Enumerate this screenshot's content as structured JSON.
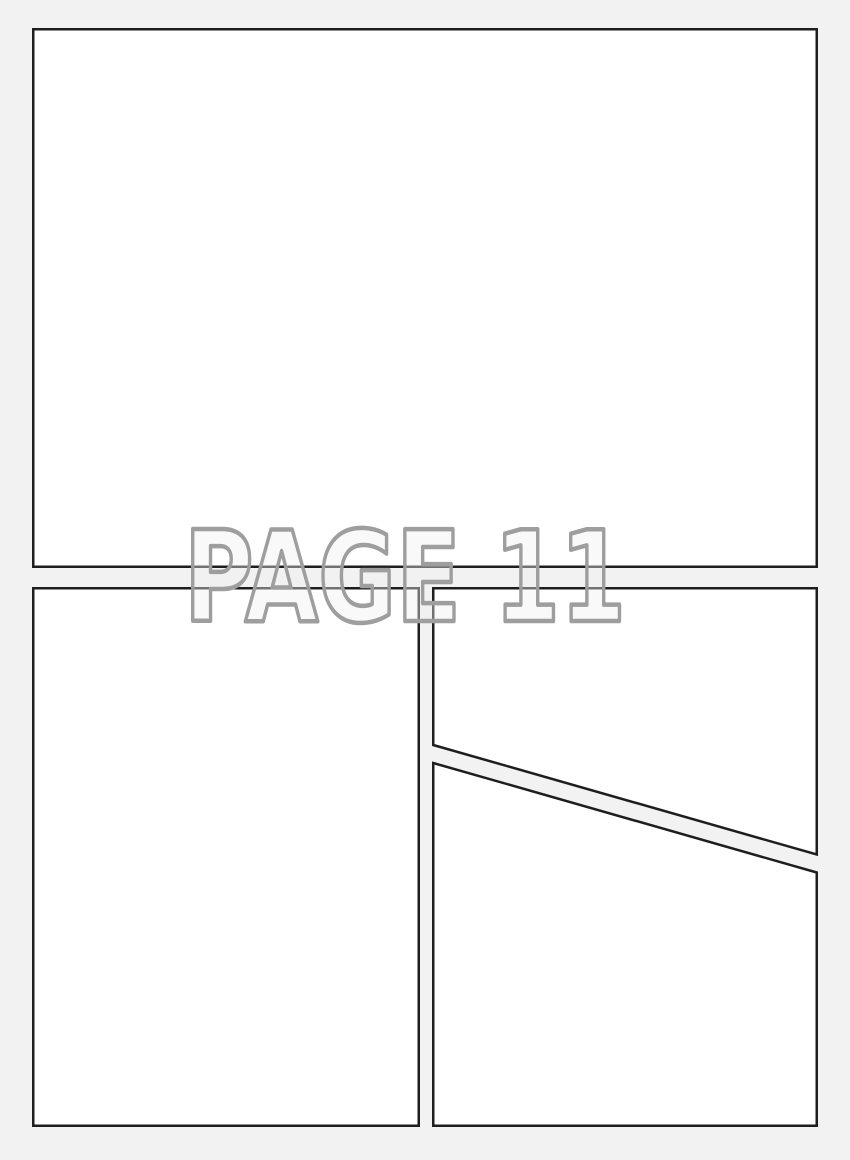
{
  "page": {
    "label": "PAGE 11"
  },
  "colors": {
    "background": "#f2f2f2",
    "panel_fill": "#ffffff",
    "panel_border": "#1e1e1e",
    "label_fill": "#f0f0f0",
    "label_fill_opacity": "0.4",
    "label_outline": "#9e9e9e"
  }
}
